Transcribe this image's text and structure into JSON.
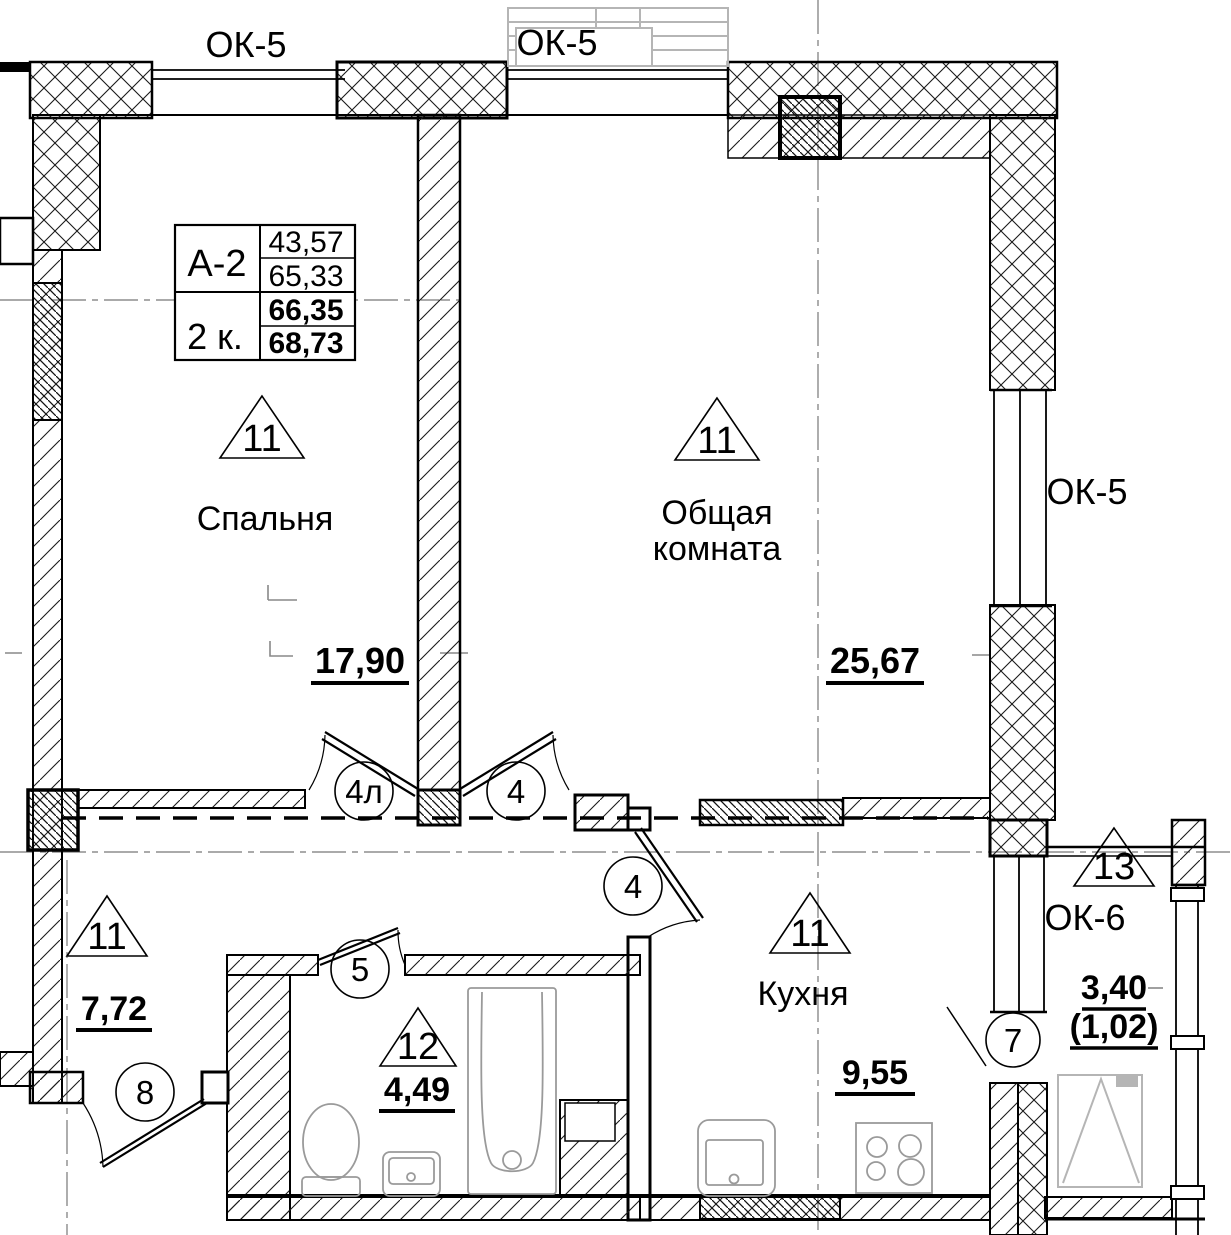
{
  "drawing": {
    "unit_table": {
      "type": "А-2",
      "rooms": "2 к.",
      "values": [
        "43,57",
        "65,33",
        "66,35",
        "68,73"
      ]
    },
    "window_labels": {
      "top_left": "ОК-5",
      "top_center": "ОК-5",
      "right": "ОК-5",
      "balcony": "ОК-6"
    },
    "rooms": {
      "bedroom": {
        "mark": "11",
        "name": "Спальня",
        "area": "17,90"
      },
      "living": {
        "mark": "11",
        "name_line1": "Общая",
        "name_line2": "комната",
        "area": "25,67"
      },
      "hall": {
        "mark": "11",
        "area": "7,72"
      },
      "kitchen": {
        "mark": "11",
        "name": "Кухня",
        "area": "9,55"
      },
      "bathroom": {
        "mark": "12",
        "area": "4,49"
      },
      "balcony": {
        "mark": "13",
        "area": "3,40",
        "area_secondary": "(1,02)"
      }
    },
    "door_tags": {
      "bedroom": "4л",
      "living": "4",
      "kitchen": "4",
      "bathroom": "5",
      "balcony": "7",
      "entrance": "8"
    }
  },
  "colors": {
    "line": "#000000",
    "centerline": "#777777",
    "fixture": "#9a9a9a",
    "balcony_frame": "#b5b5b5"
  }
}
